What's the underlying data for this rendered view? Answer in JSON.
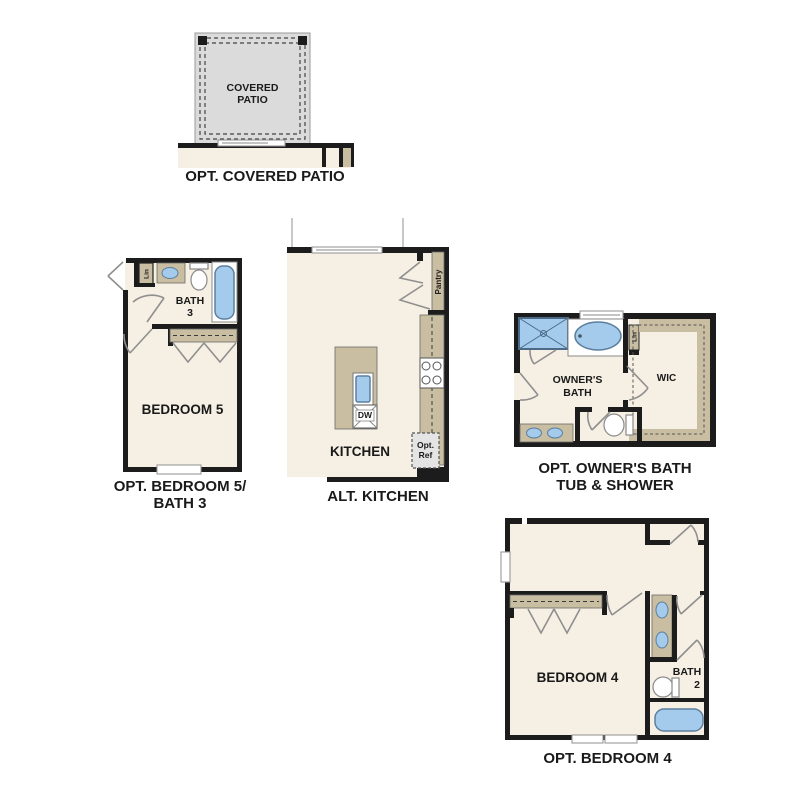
{
  "colors": {
    "floor": "#f6efe3",
    "wall": "#1c1c1c",
    "tan": "#c9bda2",
    "patio": "#dbdbdb",
    "blue": "#a5cbec",
    "bluestroke": "#5b7f9e",
    "door": "#8f8f8f",
    "textc": "#1a1a1a"
  },
  "patio": {
    "room_line1": "COVERED",
    "room_line2": "PATIO",
    "caption": "OPT. COVERED PATIO"
  },
  "bedroom5": {
    "lin": "Lin",
    "bath_line1": "BATH",
    "bath_line2": "3",
    "room": "BEDROOM 5",
    "caption_line1": "OPT. BEDROOM 5/",
    "caption_line2": "BATH 3"
  },
  "kitchen": {
    "pantry": "Pantry",
    "dw": "DW",
    "ref_line1": "Opt.",
    "ref_line2": "Ref",
    "room": "KITCHEN",
    "caption": "ALT. KITCHEN"
  },
  "owners_bath": {
    "lin": "Lin",
    "wic": "WIC",
    "room_line1": "OWNER'S",
    "room_line2": "BATH",
    "caption_line1": "OPT. OWNER'S BATH",
    "caption_line2": "TUB & SHOWER"
  },
  "bedroom4": {
    "room": "BEDROOM 4",
    "bath_line1": "BATH",
    "bath_line2": "2",
    "caption": "OPT. BEDROOM 4"
  }
}
